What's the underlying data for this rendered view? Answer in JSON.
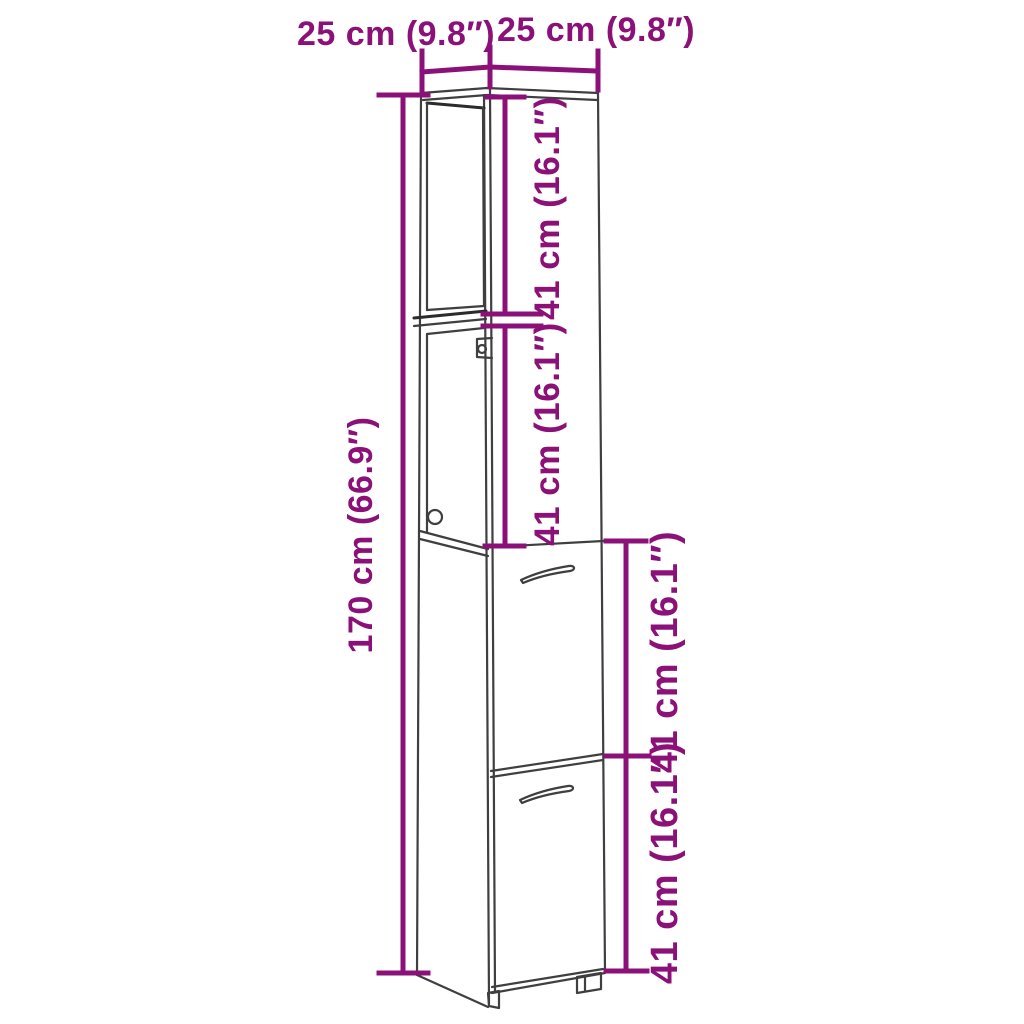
{
  "diagram": {
    "kind": "product-dimension-diagram",
    "subject": "tall narrow bathroom cabinet with open shelves and two doors",
    "colors": {
      "dimension_annotation": "#8B1179",
      "product_outline": "#3F3F3F",
      "background": "#FFFFFF"
    },
    "labels": {
      "top_left_width": "25 cm (9.8″)",
      "top_right_width": "25 cm (9.8″)",
      "total_height": "170 cm (66.9″)",
      "upper_section_a": "41 cm (16.1″)",
      "upper_section_b": "41 cm (16.1″)",
      "lower_section_a": "41 cm (16.1″)",
      "lower_section_b": "41 cm (16.1″)"
    }
  }
}
